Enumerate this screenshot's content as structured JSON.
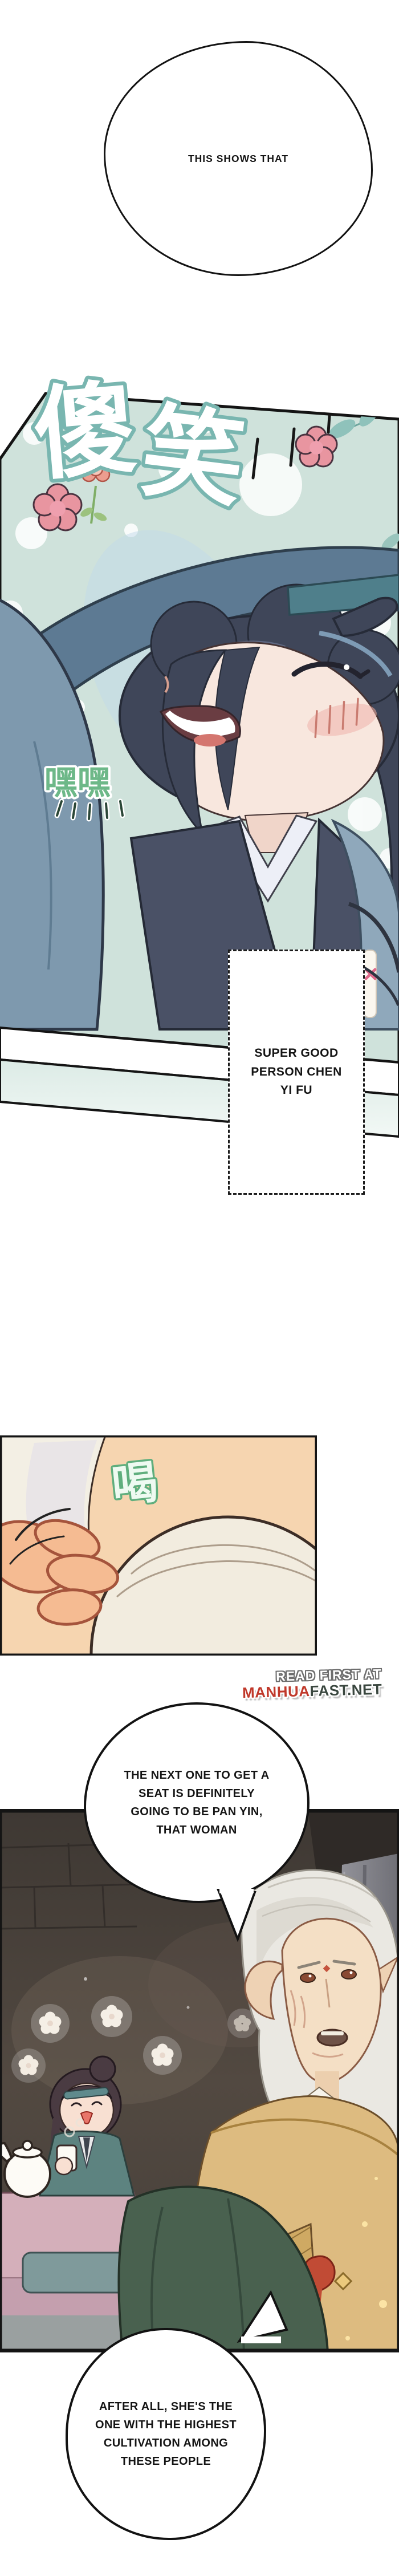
{
  "bubbles": {
    "top": {
      "text": "THIS SHOWS THAT"
    },
    "pan_yin": {
      "lines": [
        "THE NEXT ONE TO GET A",
        "SEAT IS DEFINITELY",
        "GOING TO BE PAN YIN,",
        "THAT WOMAN"
      ]
    },
    "cultivation": {
      "lines": [
        "AFTER ALL, SHE'S THE",
        "ONE WITH THE HIGHEST",
        "CULTIVATION AMONG",
        "THESE PEOPLE"
      ]
    }
  },
  "caption_box": {
    "lines": [
      "SUPER GOOD",
      "PERSON CHEN",
      "YI FU"
    ]
  },
  "sfx": {
    "silly_laugh": {
      "char1": "傻",
      "char2": "笑",
      "meaning": "silly laugh"
    },
    "hehe": {
      "text": "嘿嘿",
      "meaning": "hehe"
    },
    "gulp": {
      "text": "喝",
      "meaning": "drink/gulp"
    }
  },
  "watermark": {
    "line1": "READ FIRST AT",
    "brand_red": "MANHUA",
    "brand_dark": "FAST.NET"
  },
  "colors": {
    "panel1_teal_bg": "#cfe2db",
    "sfx_outline_teal": "#79b6b0",
    "sfx_hehe_green": "#6db888",
    "flower_pink": "#e895a0",
    "hair_navy": "#3f4659",
    "headband_teal": "#4f7f8b",
    "sleeve_blue": "#7e99ae",
    "robe_light_blue": "#8fa8bb",
    "skin_face": "#f8e7de",
    "panel3_skin_bg": "#f6d5b0",
    "scar_red": "#b4543c",
    "panel4_bg_brown": "#47403c",
    "pillar_gray": "#8b8b92",
    "old_man_hair": "#eae8e2",
    "old_man_robe_tan": "#ddbb80",
    "knot_red": "#c14b35",
    "table_pink": "#d4afba",
    "cushion_teal": "#7f9a9b",
    "foreground_green": "#49614f",
    "watermark_red": "#c0392b",
    "watermark_dark": "#3a473f",
    "outline_black": "#121212"
  }
}
